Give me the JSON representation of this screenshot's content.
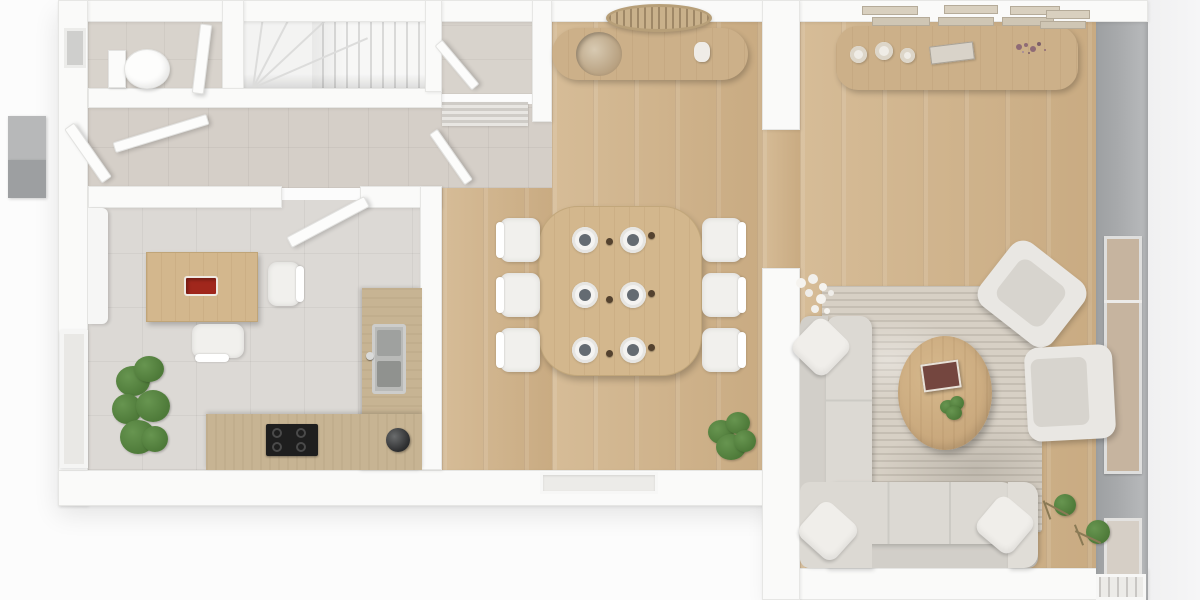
{
  "scene": {
    "kind": "3d-rendered-floor-plan-top-view",
    "style": "scandinavian-white-and-oak",
    "text_content": "none — purely graphical render"
  },
  "palette": {
    "exterior": "#fcfcfc",
    "exterior_right": "#f0f0f1",
    "wall": "#fafaf9",
    "wall_edge": "#e6e6e4",
    "gray_wall": "#a7a9ab",
    "gray_wall_light": "#b9bbbd",
    "wood_floor": "#d6bc97",
    "wood_floor_dark": "#c9ab82",
    "wood_plank_line": "rgba(146,112,74,0.22)",
    "furniture_wood": "#ccb089",
    "table_wood": "#d3b78d",
    "counter_wood": "#c7b493",
    "tile_kitchen": "#dcd9d5",
    "tile_hall": "#d5cfc8",
    "tile_wc": "#d8d3cc",
    "rug": "#d7d0c5",
    "rug_line": "rgba(125,118,106,0.20)",
    "sofa": "#dcd9d3",
    "sofa_dark": "#d2cfc9",
    "pillow": "#f0eeea",
    "chair_white": "#f1f0ed",
    "cooktop": "#1e1e1e",
    "steel": "#b9bab8",
    "accent_red": "#a1271c",
    "plant_green": "#4e7a39",
    "plant_green_light": "#679550",
    "glass": "#c6b49f",
    "shelf": "#d9d0bf",
    "flower_purple": "#8f6b76"
  },
  "rooms": [
    {
      "id": "wc",
      "name": "toilet room",
      "floor": "beige tile",
      "fixtures": [
        "wall-hung toilet",
        "door",
        "small window"
      ]
    },
    {
      "id": "staircase",
      "name": "staircase",
      "details": [
        "straight treads",
        "winder treads",
        "understair wall"
      ]
    },
    {
      "id": "hallway",
      "name": "entrance hall",
      "floor": "beige tile",
      "fixtures": [
        "entry door leaves",
        "doormat"
      ]
    },
    {
      "id": "storage",
      "name": "storage closet",
      "floor": "tile",
      "fixtures": [
        "open door"
      ]
    },
    {
      "id": "kitchen",
      "name": "kitchen",
      "floor": "gray tile",
      "fixtures": [
        "island table",
        "two chairs",
        "L-shaped counter",
        "induction cooktop",
        "double sink",
        "kettle",
        "radiator",
        "window",
        "potted plant"
      ]
    },
    {
      "id": "dining",
      "name": "dining room",
      "floor": "oak planks",
      "fixtures": [
        "console with bowl",
        "round rattan pendant",
        "dining table",
        "six chairs",
        "six place settings",
        "potted plant",
        "window"
      ]
    },
    {
      "id": "living",
      "name": "living room",
      "floor": "oak planks",
      "fixtures": [
        "sideboard with candles and dried flowers",
        "wall shelves with books",
        "area rug",
        "corner sofa",
        "three pillows",
        "oval coffee table",
        "books",
        "small plant",
        "two armchairs",
        "white flower decor",
        "two topiary stands",
        "glazed wall",
        "windows"
      ]
    }
  ],
  "counts": {
    "dining_chairs": 6,
    "place_settings": 6,
    "stair_winders": 4,
    "wall_shelf_stacks": 4,
    "sideboard_candles": 3,
    "sofa_pillows": 3,
    "topiaries": 2
  }
}
